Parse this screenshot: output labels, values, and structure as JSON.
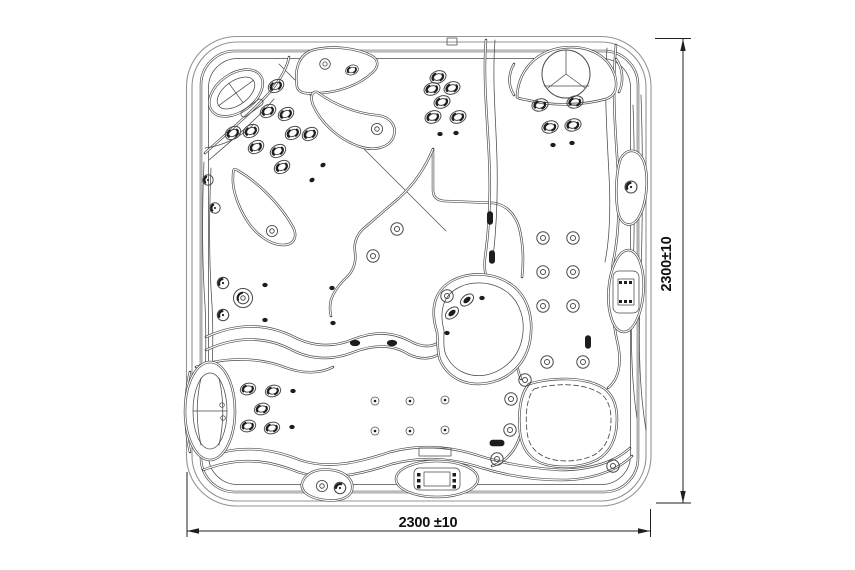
{
  "drawing": {
    "name": "hot-tub-top-view-technical-drawing",
    "dimension_bottom": {
      "label": "2300 ±10"
    },
    "dimension_right": {
      "label": "2300±10"
    }
  },
  "colors": {
    "background": "#ffffff",
    "outline": "#4a4a4a",
    "cabinet_outline": "#949494",
    "dimension_line": "#1f1f1f",
    "jet_dark": "#1d1d1d",
    "text": "#101010"
  }
}
